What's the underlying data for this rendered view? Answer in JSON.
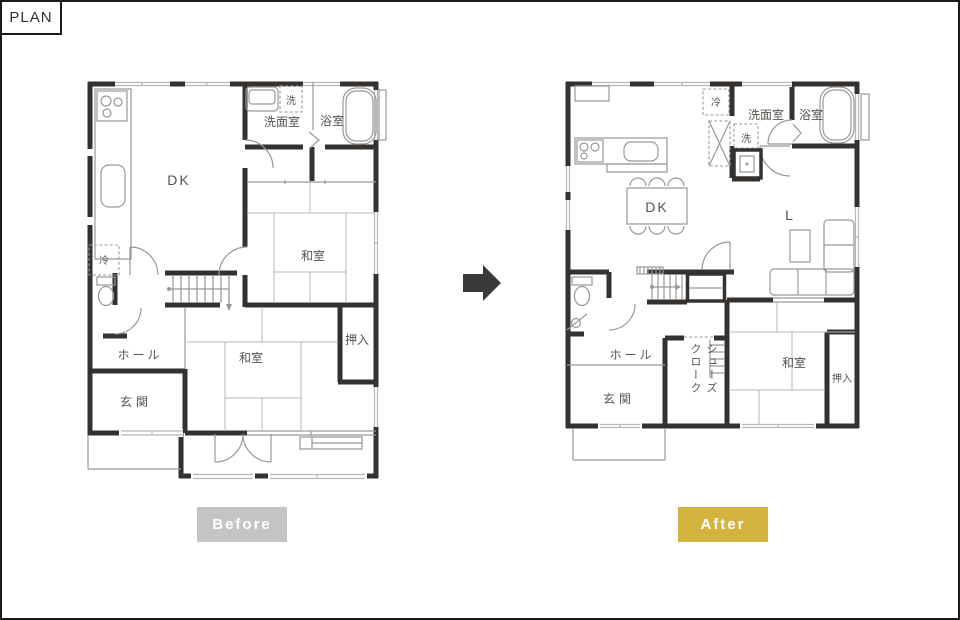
{
  "header": {
    "tag": "PLAN"
  },
  "colors": {
    "wall": "#35312e",
    "thin_line": "#9a9896",
    "light_line": "#b9b7b5",
    "label_text": "#57534e",
    "before_badge_bg": "#c4c4c4",
    "after_badge_bg": "#d4b43e",
    "badge_text": "#ffffff",
    "arrow": "#3a3a3a"
  },
  "before": {
    "badge": "Before",
    "rooms": {
      "dk": "DK",
      "washroom": "洗面室",
      "bathroom": "浴室",
      "japanese_room_upper": "和室",
      "japanese_room_lower": "和室",
      "closet": "押入",
      "hall": "ホール",
      "entrance": "玄関"
    },
    "appliances": {
      "fridge": "冷",
      "washer": "洗"
    }
  },
  "after": {
    "badge": "After",
    "rooms": {
      "dk": "DK",
      "living": "L",
      "washroom": "洗面室",
      "bathroom": "浴室",
      "japanese_room": "和室",
      "closet": "押入",
      "hall": "ホール",
      "entrance": "玄関",
      "shoe_closet": "シューズ\nクローク"
    },
    "appliances": {
      "fridge": "冷",
      "washer": "洗"
    }
  }
}
